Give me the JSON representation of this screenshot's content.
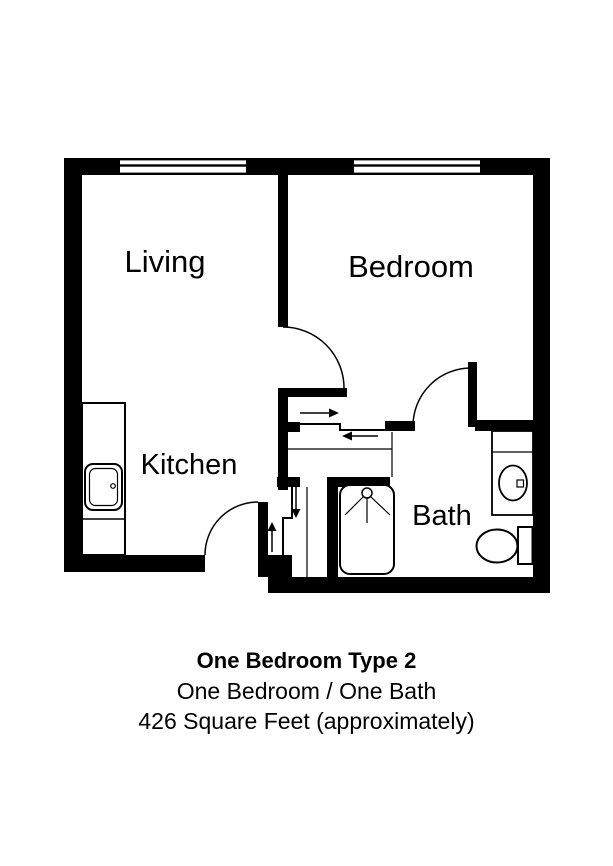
{
  "floor_plan": {
    "rooms": [
      {
        "name": "living",
        "label": "Living"
      },
      {
        "name": "bedroom",
        "label": "Bedroom"
      },
      {
        "name": "kitchen",
        "label": "Kitchen"
      },
      {
        "name": "bath",
        "label": "Bath"
      }
    ],
    "features": {
      "windows": [
        "living-window",
        "bedroom-window"
      ],
      "doors": [
        "bedroom-door",
        "bath-door",
        "entry-door"
      ],
      "sliding_doors": [
        "hall-closet-bypass-door",
        "entry-closet-bypass-door"
      ],
      "fixtures": [
        "kitchen-sink",
        "bathtub-shower",
        "vanity-sink",
        "toilet"
      ]
    },
    "colors": {
      "wall": "#000000",
      "floor": "#ffffff",
      "line": "#000000"
    }
  },
  "caption": {
    "title": "One Bedroom Type 2",
    "subtitle": "One Bedroom / One Bath",
    "area": "426 Square Feet (approximately)"
  }
}
